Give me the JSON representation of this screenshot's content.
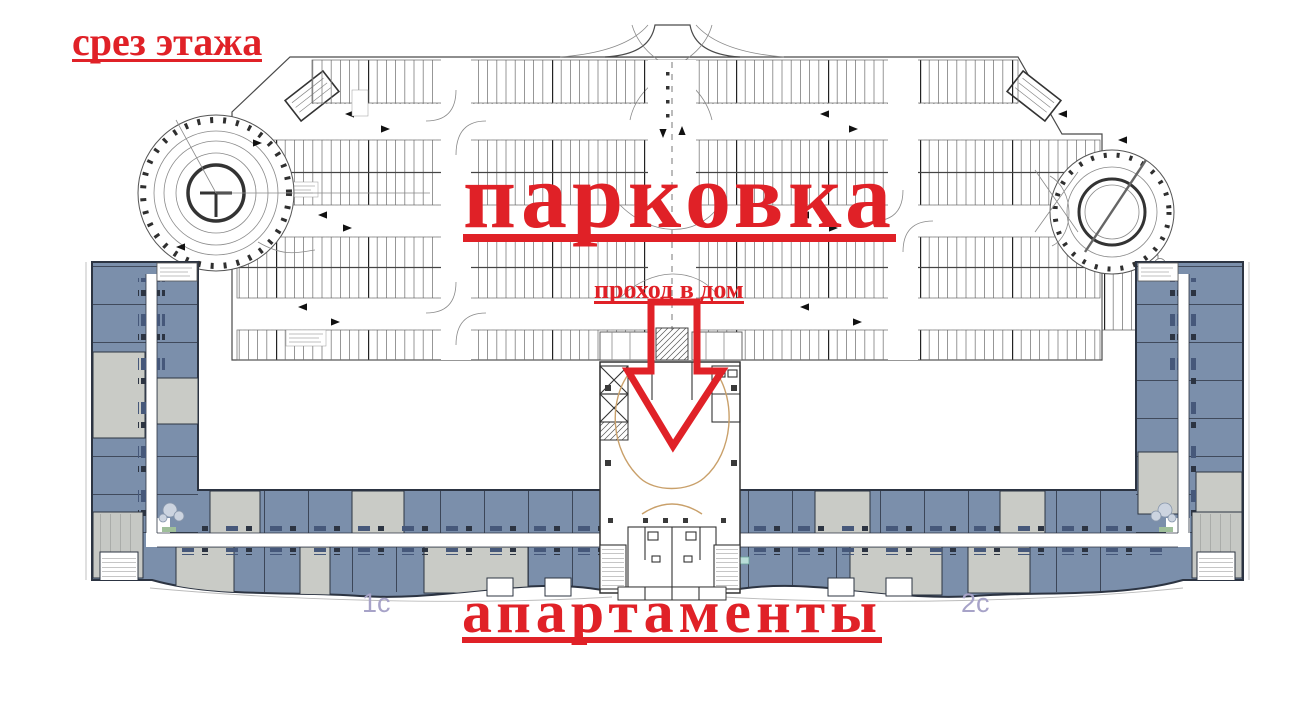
{
  "annotations": {
    "floor_section_label": "срез этажа",
    "parking_label": "парковка",
    "passage_label": "проход в дом",
    "apartments_label": "апартаменты",
    "section_1_label": "1с",
    "section_2_label": "2с"
  },
  "colors": {
    "annotation_red": "#e02127",
    "unit_blue": "#7b8fab",
    "unit_gray": "#c9cbc6",
    "outline_dark": "#2c3442",
    "section_label_purple": "#a7a3c8",
    "lobby_curve_tan": "#c9a06a",
    "greenery": "#9fbf9a"
  }
}
